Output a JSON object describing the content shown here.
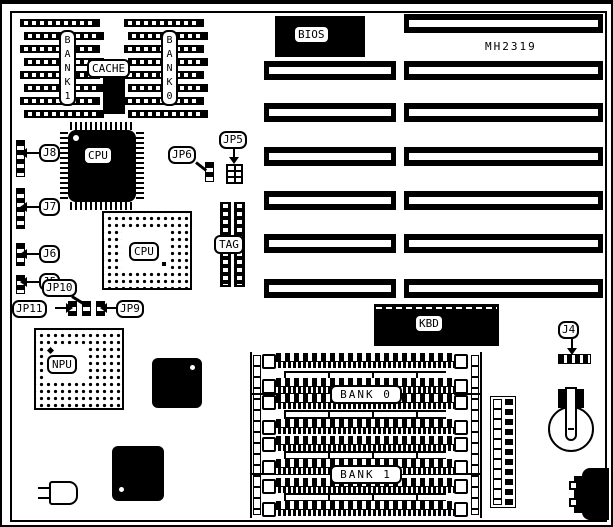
{
  "colors": {
    "ink": "#000000",
    "paper": "#ffffff"
  },
  "labels": {
    "bank1_cache": "BANK1",
    "cache": "CACHE",
    "bank0_cache": "BANK0",
    "bios": "BIOS",
    "model": "MH2319",
    "cpu": "CPU",
    "cpu_socket": "CPU",
    "npu": "NPU",
    "tag": "TAG",
    "kbd": "KBD",
    "bank0_simm": "BANK 0",
    "bank1_simm": "BANK 1",
    "j4": "J4",
    "j5": "J5",
    "j6": "J6",
    "j7": "J7",
    "j8": "J8",
    "jp5": "JP5",
    "jp6": "JP6",
    "jp9": "JP9",
    "jp10": "JP10",
    "jp11": "JP11"
  }
}
